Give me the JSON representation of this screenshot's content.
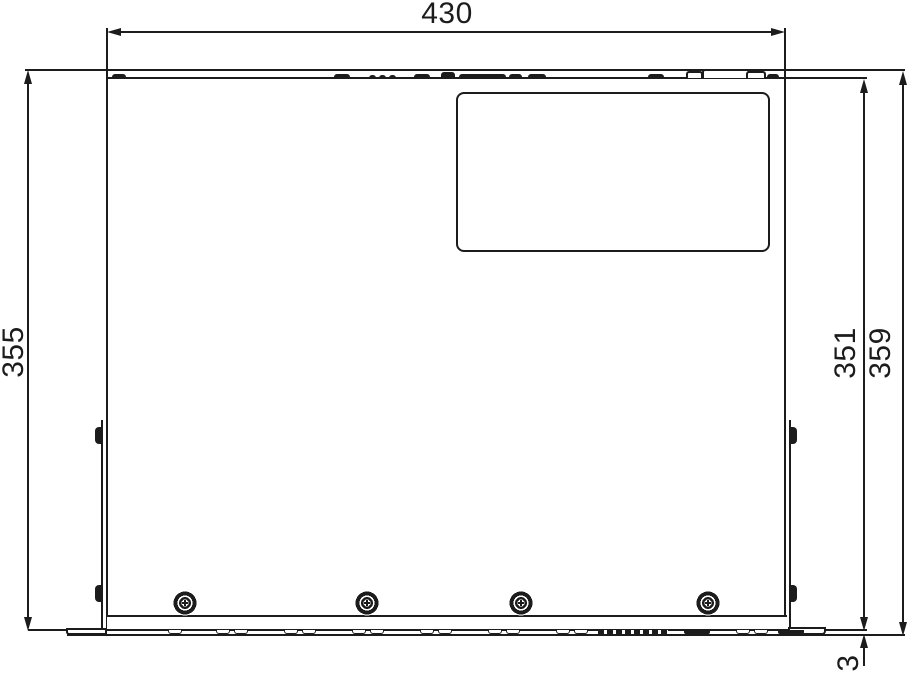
{
  "dimensions": {
    "width": "430",
    "left_height": "355",
    "right_inner_height": "351",
    "right_outer_height": "359",
    "base_gap": "3"
  },
  "colors": {
    "line": "#1c1c1c",
    "background": "#ffffff"
  },
  "geometry": {
    "top_bumps": [
      {
        "left": 112,
        "top": 74,
        "width": 14,
        "height": 4
      },
      {
        "left": 334,
        "top": 74,
        "width": 16,
        "height": 4
      },
      {
        "left": 369,
        "top": 75,
        "width": 7,
        "height": 3
      },
      {
        "left": 379,
        "top": 75,
        "width": 7,
        "height": 3
      },
      {
        "left": 389,
        "top": 75,
        "width": 7,
        "height": 3
      },
      {
        "left": 414,
        "top": 74,
        "width": 16,
        "height": 4
      },
      {
        "left": 441,
        "top": 72,
        "width": 14,
        "height": 6
      },
      {
        "left": 459,
        "top": 74,
        "width": 47,
        "height": 4
      },
      {
        "left": 509,
        "top": 74,
        "width": 13,
        "height": 4
      },
      {
        "left": 528,
        "top": 74,
        "width": 18,
        "height": 4
      },
      {
        "left": 648,
        "top": 74,
        "width": 16,
        "height": 4
      },
      {
        "left": 767,
        "top": 74,
        "width": 12,
        "height": 4
      }
    ],
    "bottom_feet": [
      {
        "left": 168,
        "top": 630,
        "width": 14,
        "height": 4
      },
      {
        "left": 216,
        "top": 630,
        "width": 14,
        "height": 4
      },
      {
        "left": 234,
        "top": 630,
        "width": 14,
        "height": 4
      },
      {
        "left": 284,
        "top": 630,
        "width": 14,
        "height": 4
      },
      {
        "left": 302,
        "top": 630,
        "width": 14,
        "height": 4
      },
      {
        "left": 352,
        "top": 630,
        "width": 14,
        "height": 4
      },
      {
        "left": 370,
        "top": 630,
        "width": 14,
        "height": 4
      },
      {
        "left": 420,
        "top": 630,
        "width": 14,
        "height": 4
      },
      {
        "left": 438,
        "top": 630,
        "width": 14,
        "height": 4
      },
      {
        "left": 488,
        "top": 630,
        "width": 14,
        "height": 4
      },
      {
        "left": 506,
        "top": 630,
        "width": 14,
        "height": 4
      },
      {
        "left": 556,
        "top": 630,
        "width": 14,
        "height": 4
      },
      {
        "left": 574,
        "top": 630,
        "width": 14,
        "height": 4
      },
      {
        "left": 736,
        "top": 630,
        "width": 14,
        "height": 4
      },
      {
        "left": 754,
        "top": 630,
        "width": 14,
        "height": 4
      }
    ],
    "bottom_dark_marks": [
      {
        "left": 684,
        "top": 630,
        "width": 26,
        "height": 4
      },
      {
        "left": 778,
        "top": 630,
        "width": 26,
        "height": 4
      }
    ],
    "screws": [
      {
        "left": 172,
        "top": 590
      },
      {
        "left": 354,
        "top": 590
      },
      {
        "left": 508,
        "top": 590
      },
      {
        "left": 695,
        "top": 590
      }
    ]
  }
}
